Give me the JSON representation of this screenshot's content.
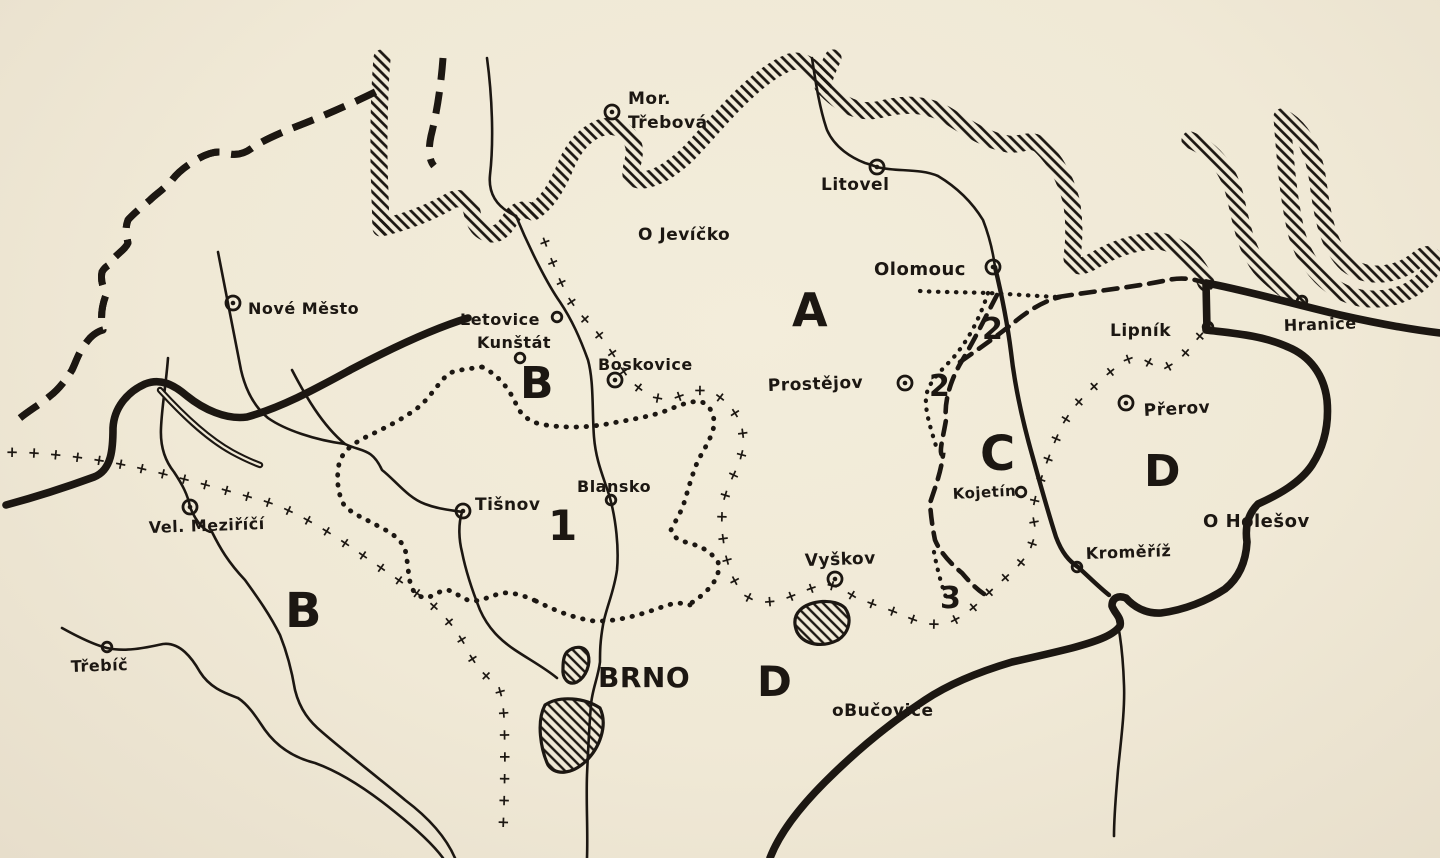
{
  "colors": {
    "paper": "#f0e9d6",
    "paper_edge": "#e7decb",
    "ink": "#1c1712"
  },
  "symbols": {
    "cross_chain_glyph": "+"
  },
  "map": {
    "places": [
      {
        "name": "Moravska Trebova",
        "lines": [
          "Mor.",
          "Třebová"
        ],
        "marker": "circled-dot",
        "mx": 612,
        "my": 112,
        "lx": 628,
        "ly": 104,
        "lh": 24,
        "size": 17
      },
      {
        "name": "Litovel",
        "lines": [
          "Litovel"
        ],
        "marker": "circled-dot",
        "mx": 877,
        "my": 167,
        "lx": 821,
        "ly": 190,
        "size": 17
      },
      {
        "name": "Jevicko",
        "lines": [
          "O Jevíčko"
        ],
        "marker": "none",
        "lx": 638,
        "ly": 240,
        "size": 17
      },
      {
        "name": "Olomouc",
        "lines": [
          "Olomouc"
        ],
        "marker": "circled-dot",
        "mx": 993,
        "my": 267,
        "lx": 874,
        "ly": 275,
        "size": 18
      },
      {
        "name": "Prostejov",
        "lines": [
          "Prostějov"
        ],
        "marker": "circled-dot",
        "mx": 905,
        "my": 383,
        "lx": 768,
        "ly": 391,
        "size": 17,
        "rot": -2
      },
      {
        "name": "Lipnik",
        "lines": [
          "Lipník"
        ],
        "marker": "small-circle",
        "mx": 1208,
        "my": 327,
        "lx": 1110,
        "ly": 336,
        "size": 17
      },
      {
        "name": "Hranice",
        "lines": [
          "Hranice"
        ],
        "marker": "small-circle",
        "mx": 1302,
        "my": 301,
        "lx": 1284,
        "ly": 331,
        "size": 16,
        "rot": -2
      },
      {
        "name": "Prerov",
        "lines": [
          "Přerov"
        ],
        "marker": "circled-dot",
        "mx": 1126,
        "my": 403,
        "lx": 1144,
        "ly": 416,
        "size": 17,
        "rot": -3
      },
      {
        "name": "Kojetin",
        "lines": [
          "Kojetín"
        ],
        "marker": "small-circle",
        "mx": 1021,
        "my": 492,
        "lx": 953,
        "ly": 499,
        "size": 15,
        "rot": -3
      },
      {
        "name": "Kromeriz",
        "lines": [
          "Kroměříž"
        ],
        "marker": "small-circle",
        "mx": 1077,
        "my": 567,
        "lx": 1086,
        "ly": 559,
        "size": 16,
        "rot": -2
      },
      {
        "name": "Holesov",
        "lines": [
          "O Holešov"
        ],
        "marker": "none",
        "lx": 1203,
        "ly": 527,
        "size": 18
      },
      {
        "name": "Vyskov",
        "lines": [
          "Vyškov"
        ],
        "marker": "circled-dot",
        "mx": 835,
        "my": 579,
        "lx": 805,
        "ly": 566,
        "size": 17,
        "rot": -2
      },
      {
        "name": "Bucovice",
        "lines": [
          "oBučovice"
        ],
        "marker": "none",
        "lx": 832,
        "ly": 716,
        "size": 17
      },
      {
        "name": "Brno",
        "lines": [
          "BRNO"
        ],
        "marker": "none",
        "lx": 598,
        "ly": 687,
        "size": 28
      },
      {
        "name": "Blansko",
        "lines": [
          "Blansko"
        ],
        "marker": "small-circle",
        "mx": 611,
        "my": 500,
        "lx": 577,
        "ly": 492,
        "size": 16
      },
      {
        "name": "Tisnov",
        "lines": [
          "Tišnov"
        ],
        "marker": "circled-dot",
        "mx": 463,
        "my": 511,
        "lx": 475,
        "ly": 510,
        "size": 17
      },
      {
        "name": "Letovice",
        "lines": [
          "Letovice"
        ],
        "marker": "small-circle",
        "mx": 557,
        "my": 317,
        "lx": 460,
        "ly": 325,
        "size": 16
      },
      {
        "name": "Kunstat",
        "lines": [
          "Kunštát"
        ],
        "marker": "small-circle",
        "mx": 520,
        "my": 358,
        "lx": 477,
        "ly": 348,
        "size": 16
      },
      {
        "name": "Boskovice",
        "lines": [
          "Boskovice"
        ],
        "marker": "circled-dot",
        "mx": 615,
        "my": 380,
        "lx": 598,
        "ly": 370,
        "size": 16
      },
      {
        "name": "Nove Mesto",
        "lines": [
          "Nové Město"
        ],
        "marker": "circled-dot",
        "mx": 233,
        "my": 303,
        "lx": 248,
        "ly": 314,
        "size": 16
      },
      {
        "name": "Velke Mezirici",
        "lines": [
          "Vel. Meziříčí"
        ],
        "marker": "circled-dot",
        "mx": 190,
        "my": 507,
        "lx": 149,
        "ly": 533,
        "size": 16,
        "rot": -2
      },
      {
        "name": "Trebic",
        "lines": [
          "Třebíč"
        ],
        "marker": "small-circle",
        "mx": 107,
        "my": 647,
        "lx": 71,
        "ly": 672,
        "size": 16,
        "rot": -2
      }
    ],
    "regions": [
      {
        "label": "A",
        "x": 792,
        "y": 326,
        "size": 46
      },
      {
        "label": "B",
        "x": 520,
        "y": 398,
        "size": 44
      },
      {
        "label": "B",
        "x": 285,
        "y": 627,
        "size": 48
      },
      {
        "label": "C",
        "x": 980,
        "y": 470,
        "size": 48
      },
      {
        "label": "D",
        "x": 1144,
        "y": 486,
        "size": 44
      },
      {
        "label": "D",
        "x": 757,
        "y": 696,
        "size": 42
      }
    ],
    "zones": [
      {
        "label": "1",
        "x": 548,
        "y": 540,
        "size": 42
      },
      {
        "label": "2",
        "x": 982,
        "y": 339,
        "size": 30
      },
      {
        "label": "2",
        "x": 929,
        "y": 396,
        "size": 30
      },
      {
        "label": "3",
        "x": 940,
        "y": 608,
        "size": 30
      }
    ]
  }
}
